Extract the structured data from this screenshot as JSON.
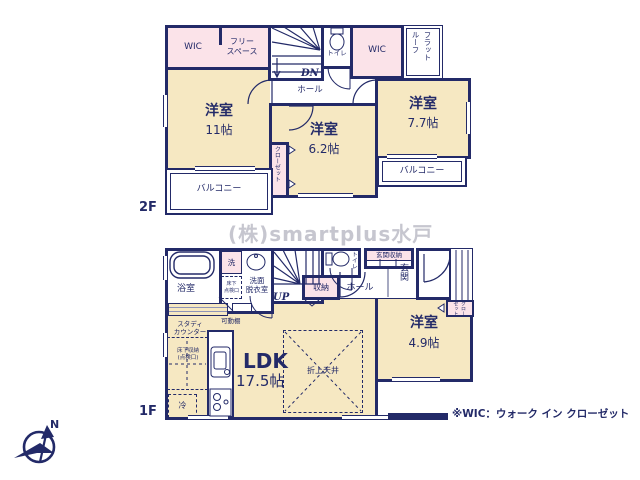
{
  "colors": {
    "wall": "#232a68",
    "room_tan": "#f6e8c2",
    "accent_pink": "#fbe3e9",
    "text_navy": "#232a68",
    "watermark_gray": "#b9b9c4"
  },
  "watermark": "(株)smartplus水戸",
  "footnote": "※WIC：ウォーク イン クローゼット",
  "compass": {
    "north": "N"
  },
  "floor2": {
    "label": "2F",
    "wic_left": "WIC",
    "free_space": "フリー\nスペース",
    "stairs_dn": "DN",
    "hall": "ホール",
    "toilet": "トイレ",
    "wic_right": "WIC",
    "flat_roof": "フラット\nルーフ",
    "room1": {
      "name": "洋室",
      "size": "11帖"
    },
    "room2": {
      "name": "洋室",
      "size": "6.2帖"
    },
    "room3": {
      "name": "洋室",
      "size": "7.7帖"
    },
    "closet": "クローゼット",
    "balcony_left": "バルコニー",
    "balcony_right": "バルコニー"
  },
  "floor1": {
    "label": "1F",
    "bath": "浴室",
    "laundry": "洗",
    "washroom": "洗面\n脱衣室",
    "floor_access": "床下\n点検口",
    "stairs_up": "UP",
    "storage": "収納",
    "toilet": "トイレ",
    "entrance_storage": "玄関収納",
    "hall": "ホール",
    "entrance": "玄関",
    "closet": "クロー\nゼット",
    "room": {
      "name": "洋室",
      "size": "4.9帖"
    },
    "ldk": {
      "name": "LDK",
      "size": "17.5帖"
    },
    "raised_ceiling": "折上天井",
    "study_counter": "スタディ\nカウンター",
    "movable_shelf": "可動棚",
    "floor_storage": "床下収納\n(点検口)",
    "fridge": "冷"
  }
}
